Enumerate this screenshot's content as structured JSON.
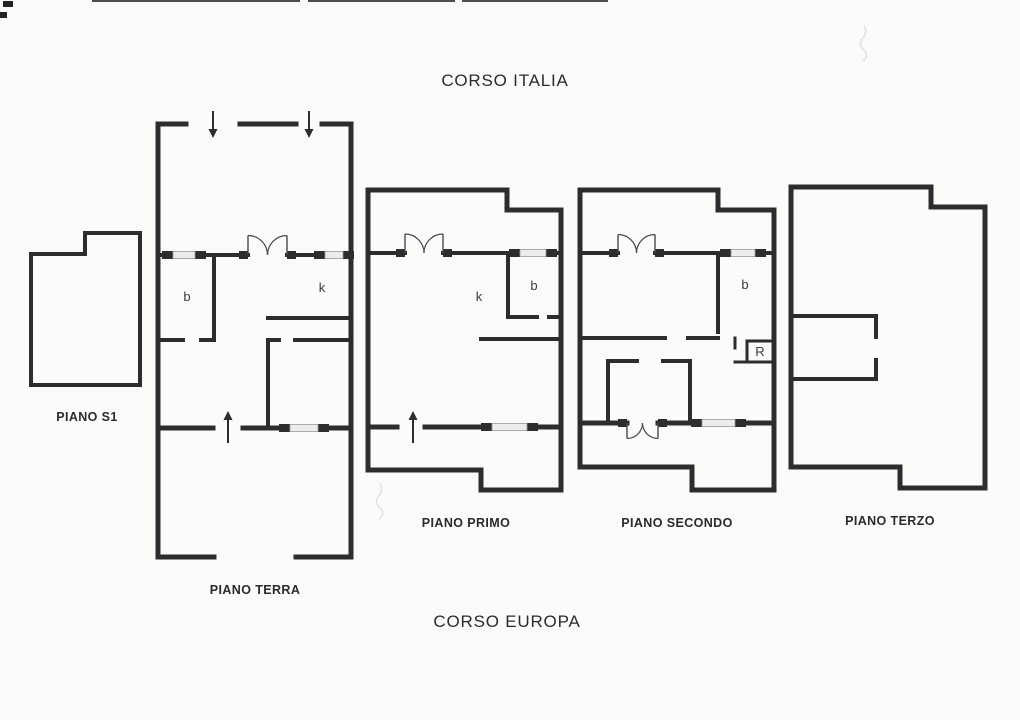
{
  "titles": {
    "top": "CORSO ITALIA",
    "bottom": "CORSO EUROPA"
  },
  "colors": {
    "paper": "#fbfbfa",
    "wall": "#2d2d2d",
    "door": "#4a4a4a",
    "window_fill": "#ececec",
    "window_border": "#999999",
    "text": "#2b2b2b"
  },
  "floors": [
    {
      "id": "piano-s1",
      "label": "PIANO S1",
      "label_x": 87,
      "label_y": 421,
      "walls": [
        [
          31,
          254,
          85,
          254,
          4
        ],
        [
          85,
          233,
          85,
          254,
          4
        ],
        [
          85,
          233,
          140,
          233,
          4
        ],
        [
          140,
          233,
          140,
          385,
          4
        ],
        [
          31,
          385,
          140,
          385,
          4
        ],
        [
          31,
          254,
          31,
          385,
          4
        ]
      ],
      "windows": [],
      "doors": [],
      "arrows": [],
      "rooms": []
    },
    {
      "id": "piano-terra",
      "label": "PIANO TERRA",
      "label_x": 255,
      "label_y": 594,
      "walls": [
        [
          158,
          124,
          186,
          124,
          5
        ],
        [
          240,
          124,
          296,
          124,
          5
        ],
        [
          322,
          124,
          351,
          124,
          5
        ],
        [
          158,
          124,
          158,
          557,
          5
        ],
        [
          351,
          124,
          351,
          557,
          5
        ],
        [
          158,
          557,
          214,
          557,
          5
        ],
        [
          296,
          557,
          351,
          557,
          5
        ],
        [
          158,
          255,
          173,
          255,
          4
        ],
        [
          195,
          255,
          248,
          255,
          4
        ],
        [
          287,
          255,
          325,
          255,
          4
        ],
        [
          343,
          255,
          351,
          255,
          4
        ],
        [
          214,
          255,
          214,
          340,
          4
        ],
        [
          158,
          340,
          183,
          340,
          4
        ],
        [
          201,
          340,
          214,
          340,
          4
        ],
        [
          268,
          318,
          351,
          318,
          4
        ],
        [
          268,
          340,
          279,
          340,
          4
        ],
        [
          295,
          340,
          351,
          340,
          4
        ],
        [
          268,
          340,
          268,
          428,
          4
        ],
        [
          158,
          428,
          213,
          428,
          5
        ],
        [
          243,
          428,
          290,
          428,
          5
        ],
        [
          318,
          428,
          351,
          428,
          5
        ]
      ],
      "windows": [
        [
          173,
          255,
          22
        ],
        [
          325,
          255,
          18
        ],
        [
          290,
          428,
          28
        ]
      ],
      "doors": [
        {
          "x1": 248,
          "x2": 287,
          "y": 255,
          "dir": "up"
        }
      ],
      "arrows": [
        {
          "x": 213,
          "tail": 111,
          "head": 138
        },
        {
          "x": 309,
          "tail": 111,
          "head": 138
        },
        {
          "x": 228,
          "tail": 443,
          "head": 411
        }
      ],
      "rooms": [
        {
          "t": "b",
          "x": 187,
          "y": 301
        },
        {
          "t": "k",
          "x": 322,
          "y": 292
        }
      ]
    },
    {
      "id": "piano-primo",
      "label": "PIANO PRIMO",
      "label_x": 466,
      "label_y": 527,
      "walls": [
        [
          368,
          190,
          507,
          190,
          5
        ],
        [
          507,
          190,
          507,
          210,
          5
        ],
        [
          507,
          210,
          561,
          210,
          5
        ],
        [
          368,
          190,
          368,
          470,
          5
        ],
        [
          561,
          210,
          561,
          490,
          5
        ],
        [
          368,
          470,
          481,
          470,
          5
        ],
        [
          481,
          470,
          481,
          490,
          5
        ],
        [
          481,
          490,
          561,
          490,
          5
        ],
        [
          368,
          253,
          405,
          253,
          4
        ],
        [
          443,
          253,
          520,
          253,
          4
        ],
        [
          546,
          253,
          561,
          253,
          4
        ],
        [
          508,
          253,
          508,
          317,
          4
        ],
        [
          508,
          317,
          537,
          317,
          4
        ],
        [
          549,
          317,
          561,
          317,
          4
        ],
        [
          481,
          339,
          561,
          339,
          4
        ],
        [
          368,
          427,
          397,
          427,
          5
        ],
        [
          425,
          427,
          492,
          427,
          5
        ],
        [
          527,
          427,
          561,
          427,
          5
        ]
      ],
      "windows": [
        [
          520,
          253,
          26
        ],
        [
          492,
          427,
          35
        ]
      ],
      "doors": [
        {
          "x1": 405,
          "x2": 443,
          "y": 253,
          "dir": "up"
        }
      ],
      "arrows": [
        {
          "x": 413,
          "tail": 443,
          "head": 411
        }
      ],
      "rooms": [
        {
          "t": "k",
          "x": 479,
          "y": 301
        },
        {
          "t": "b",
          "x": 534,
          "y": 290
        }
      ]
    },
    {
      "id": "piano-secondo",
      "label": "PIANO SECONDO",
      "label_x": 677,
      "label_y": 527,
      "walls": [
        [
          580,
          190,
          718,
          190,
          5
        ],
        [
          718,
          190,
          718,
          210,
          5
        ],
        [
          718,
          210,
          774,
          210,
          5
        ],
        [
          580,
          190,
          580,
          467,
          5
        ],
        [
          774,
          210,
          774,
          490,
          5
        ],
        [
          580,
          467,
          692,
          467,
          5
        ],
        [
          692,
          467,
          692,
          490,
          5
        ],
        [
          692,
          490,
          774,
          490,
          5
        ],
        [
          580,
          253,
          618,
          253,
          4
        ],
        [
          655,
          253,
          731,
          253,
          4
        ],
        [
          755,
          253,
          774,
          253,
          4
        ],
        [
          718,
          253,
          718,
          332,
          4
        ],
        [
          580,
          338,
          665,
          338,
          4
        ],
        [
          688,
          338,
          718,
          338,
          4
        ],
        [
          735,
          338,
          735,
          348,
          3
        ],
        [
          747,
          341,
          774,
          341,
          3
        ],
        [
          747,
          341,
          747,
          362,
          3
        ],
        [
          735,
          362,
          774,
          362,
          3
        ],
        [
          608,
          361,
          637,
          361,
          4
        ],
        [
          663,
          361,
          690,
          361,
          4
        ],
        [
          608,
          361,
          608,
          423,
          4
        ],
        [
          690,
          361,
          690,
          423,
          4
        ],
        [
          580,
          423,
          627,
          423,
          5
        ],
        [
          658,
          423,
          702,
          423,
          5
        ],
        [
          735,
          423,
          774,
          423,
          5
        ]
      ],
      "windows": [
        [
          731,
          253,
          24
        ],
        [
          702,
          423,
          33
        ]
      ],
      "doors": [
        {
          "x1": 618,
          "x2": 655,
          "y": 253,
          "dir": "up"
        },
        {
          "x1": 627,
          "x2": 658,
          "y": 423,
          "dir": "down"
        }
      ],
      "arrows": [],
      "rooms": [
        {
          "t": "b",
          "x": 745,
          "y": 289
        },
        {
          "t": "R",
          "x": 760,
          "y": 356
        }
      ]
    },
    {
      "id": "piano-terzo",
      "label": "PIANO TERZO",
      "label_x": 890,
      "label_y": 525,
      "walls": [
        [
          791,
          187,
          931,
          187,
          5
        ],
        [
          931,
          187,
          931,
          207,
          5
        ],
        [
          931,
          207,
          985,
          207,
          5
        ],
        [
          791,
          187,
          791,
          467,
          5
        ],
        [
          985,
          207,
          985,
          488,
          5
        ],
        [
          791,
          467,
          900,
          467,
          5
        ],
        [
          900,
          467,
          900,
          488,
          5
        ],
        [
          900,
          488,
          985,
          488,
          5
        ],
        [
          791,
          316,
          876,
          316,
          4
        ],
        [
          876,
          316,
          876,
          337,
          4
        ],
        [
          876,
          360,
          876,
          379,
          4
        ],
        [
          791,
          379,
          876,
          379,
          4
        ]
      ],
      "windows": [],
      "doors": [],
      "arrows": [],
      "rooms": []
    }
  ],
  "artifacts": {
    "top_edge_lines": [
      [
        92,
        1,
        300,
        1
      ],
      [
        308,
        1,
        455,
        1
      ],
      [
        462,
        1,
        608,
        1
      ]
    ],
    "corner_marks": [
      [
        3,
        1,
        10,
        6
      ],
      [
        0,
        12,
        7,
        6
      ]
    ],
    "smudges": [
      {
        "x": 864,
        "y": 40
      },
      {
        "x": 380,
        "y": 498
      }
    ]
  }
}
